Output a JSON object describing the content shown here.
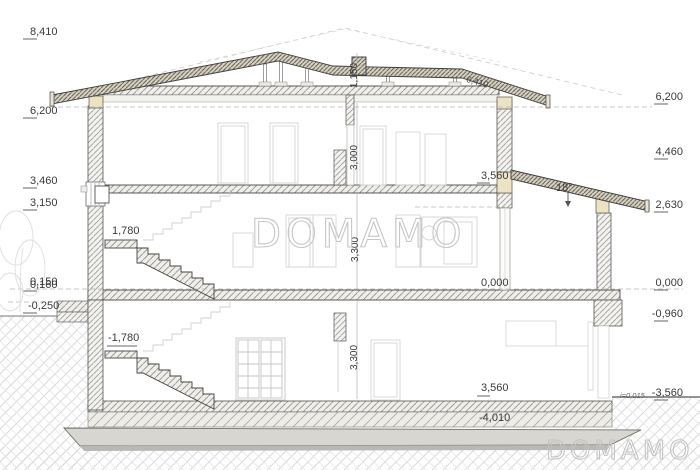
{
  "title": "house-cross-section-drawing",
  "watermark": {
    "center": "DOMAMO",
    "corner": "DOMAMO"
  },
  "levels": {
    "left": [
      "8,410",
      "6,200",
      "3,460",
      "3,150",
      "0,150",
      "0,160",
      "-0,250"
    ],
    "right": [
      "6,200",
      "4,460",
      "2,630",
      "0,000",
      "-0,960",
      "-3,560"
    ],
    "floor_zero": "0,000",
    "second_floor": "3,560",
    "bottom_dim": "3,560",
    "slab_bottom": "-4,010",
    "upper_landing": "1,780",
    "lower_landing": "-1,780"
  },
  "dimensions": {
    "ridge_height": "1,150",
    "second_floor_height": "3,000",
    "first_floor_height": "3,300",
    "basement_height": "3,300",
    "roof_edge": "6,410",
    "roof_slope_angle": "18°",
    "floor_slope": "i=0,015"
  },
  "colors": {
    "line": "#3c3c3c",
    "wood": "#ece3c4",
    "roof_fill": "#d8d2c2",
    "watermark": "#c7c7c7",
    "background": "#ffffff"
  }
}
